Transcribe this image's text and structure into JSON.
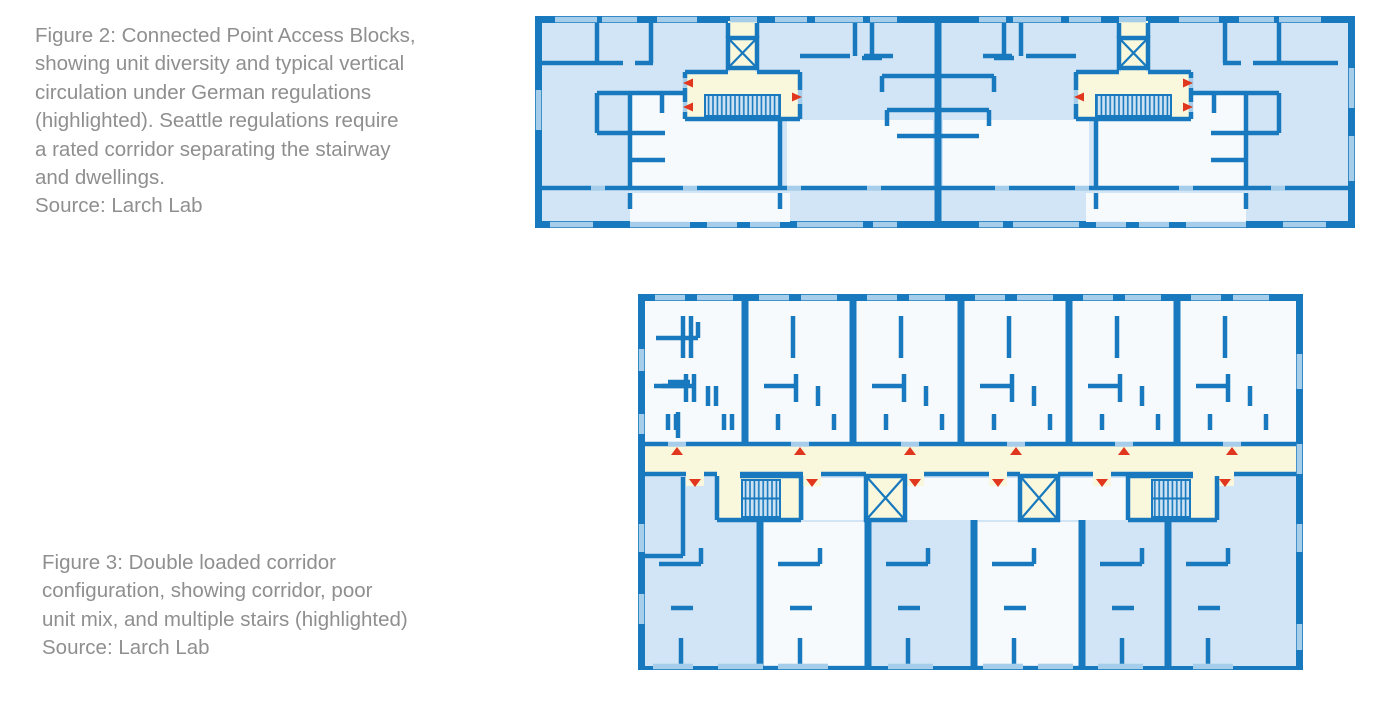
{
  "page": {
    "background": "#FFFFFF"
  },
  "colors": {
    "wall": "#1879BE",
    "room_light": "#D2E5F6",
    "room_white": "#F7FAFD",
    "highlight": "#FAF8DC",
    "window": "#A6CEEA",
    "stair_fill": "#CDE3F3",
    "marker_red": "#E0371E",
    "caption_text": "#8F8F8F",
    "page_bg": "#FFFFFF"
  },
  "figures": {
    "figure2": {
      "caption": "Figure 2: Connected Point Access Blocks,\nshowing unit diversity and typical vertical\ncirculation under German regulations\n(highlighted). Seattle regulations require\na rated corridor separating the stairway\nand dwellings.",
      "source": "Source: Larch Lab",
      "plan_type": "connected point access blocks",
      "highlighted": "two stair cores with elevators"
    },
    "figure3": {
      "caption": "Figure 3: Double loaded corridor\nconfiguration, showing corridor, poor\nunit mix, and multiple stairs (highlighted)",
      "source": "Source: Larch Lab",
      "plan_type": "double loaded corridor",
      "highlighted": "central corridor, two stairs, two elevators"
    }
  }
}
